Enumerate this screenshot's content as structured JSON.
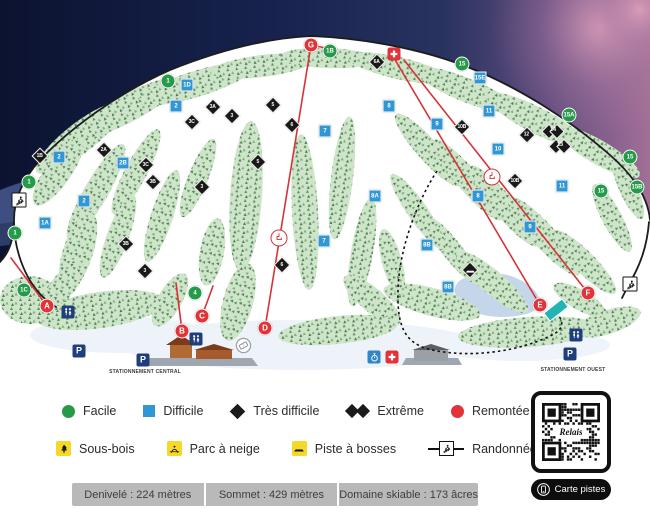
{
  "map": {
    "parking_labels": [
      {
        "text": "STATIONNEMENT CENTRAL",
        "x": 145,
        "y": 372
      },
      {
        "text": "STATIONNEMENT OUEST",
        "x": 573,
        "y": 370
      }
    ],
    "markers": [
      {
        "kind": "green",
        "label": "1",
        "x": 168,
        "y": 81
      },
      {
        "kind": "green",
        "label": "1B",
        "x": 330,
        "y": 51
      },
      {
        "kind": "green",
        "label": "1",
        "x": 29,
        "y": 182
      },
      {
        "kind": "green",
        "label": "1",
        "x": 15,
        "y": 233
      },
      {
        "kind": "green",
        "label": "1C",
        "x": 24,
        "y": 290
      },
      {
        "kind": "green",
        "label": "4",
        "x": 195,
        "y": 293
      },
      {
        "kind": "green",
        "label": "15",
        "x": 462,
        "y": 64
      },
      {
        "kind": "green",
        "label": "15A",
        "x": 569,
        "y": 115
      },
      {
        "kind": "green",
        "label": "15",
        "x": 630,
        "y": 157
      },
      {
        "kind": "green",
        "label": "15B",
        "x": 637,
        "y": 187
      },
      {
        "kind": "green",
        "label": "15",
        "x": 601,
        "y": 191
      },
      {
        "kind": "blue",
        "label": "1D",
        "x": 187,
        "y": 85
      },
      {
        "kind": "blue",
        "label": "2",
        "x": 176,
        "y": 106
      },
      {
        "kind": "blue",
        "label": "2",
        "x": 59,
        "y": 157
      },
      {
        "kind": "blue",
        "label": "2",
        "x": 84,
        "y": 201
      },
      {
        "kind": "blue",
        "label": "2B",
        "x": 123,
        "y": 163
      },
      {
        "kind": "blue",
        "label": "1A",
        "x": 45,
        "y": 223
      },
      {
        "kind": "blue",
        "label": "7",
        "x": 325,
        "y": 131
      },
      {
        "kind": "blue",
        "label": "7",
        "x": 324,
        "y": 241
      },
      {
        "kind": "blue",
        "label": "8",
        "x": 389,
        "y": 106
      },
      {
        "kind": "blue",
        "label": "8",
        "x": 478,
        "y": 196
      },
      {
        "kind": "blue",
        "label": "8A",
        "x": 375,
        "y": 196
      },
      {
        "kind": "blue",
        "label": "8B",
        "x": 427,
        "y": 245
      },
      {
        "kind": "blue",
        "label": "8B",
        "x": 448,
        "y": 287
      },
      {
        "kind": "blue",
        "label": "9",
        "x": 437,
        "y": 124
      },
      {
        "kind": "blue",
        "label": "9",
        "x": 530,
        "y": 227
      },
      {
        "kind": "blue",
        "label": "10",
        "x": 498,
        "y": 149
      },
      {
        "kind": "blue",
        "label": "11",
        "x": 489,
        "y": 111
      },
      {
        "kind": "blue",
        "label": "11",
        "x": 562,
        "y": 186
      },
      {
        "kind": "blue",
        "label": "15E",
        "x": 480,
        "y": 78
      },
      {
        "kind": "diamond",
        "label": "1B",
        "x": 40,
        "y": 156
      },
      {
        "kind": "diamond",
        "label": "2A",
        "x": 104,
        "y": 150
      },
      {
        "kind": "diamond",
        "label": "3A",
        "x": 213,
        "y": 107
      },
      {
        "kind": "diamond",
        "label": "3",
        "x": 232,
        "y": 116
      },
      {
        "kind": "diamond",
        "label": "3C",
        "x": 192,
        "y": 122
      },
      {
        "kind": "diamond",
        "label": "3C",
        "x": 146,
        "y": 165
      },
      {
        "kind": "diamond",
        "label": "3B",
        "x": 153,
        "y": 182
      },
      {
        "kind": "diamond",
        "label": "3B",
        "x": 126,
        "y": 244
      },
      {
        "kind": "diamond",
        "label": "3",
        "x": 202,
        "y": 187
      },
      {
        "kind": "diamond",
        "label": "3",
        "x": 145,
        "y": 271
      },
      {
        "kind": "diamond",
        "label": "5",
        "x": 273,
        "y": 105
      },
      {
        "kind": "diamond",
        "label": "5",
        "x": 258,
        "y": 162
      },
      {
        "kind": "diamond",
        "label": "6",
        "x": 292,
        "y": 125
      },
      {
        "kind": "diamond",
        "label": "6",
        "x": 282,
        "y": 265
      },
      {
        "kind": "diamond",
        "label": "6A",
        "x": 377,
        "y": 62
      },
      {
        "kind": "diamond",
        "label": "10B",
        "x": 462,
        "y": 127
      },
      {
        "kind": "diamond",
        "label": "10B",
        "x": 515,
        "y": 181
      },
      {
        "kind": "diamond",
        "label": "12",
        "x": 527,
        "y": 135
      },
      {
        "kind": "double",
        "label": "14",
        "x": 553,
        "y": 131
      },
      {
        "kind": "double",
        "label": "13",
        "x": 560,
        "y": 146
      },
      {
        "kind": "bosses",
        "label": "",
        "x": 470,
        "y": 270
      },
      {
        "kind": "lift",
        "label": "A",
        "x": 47,
        "y": 306
      },
      {
        "kind": "lift",
        "label": "B",
        "x": 182,
        "y": 331
      },
      {
        "kind": "lift",
        "label": "C",
        "x": 202,
        "y": 316
      },
      {
        "kind": "lift",
        "label": "D",
        "x": 265,
        "y": 328
      },
      {
        "kind": "lift",
        "label": "E",
        "x": 540,
        "y": 305
      },
      {
        "kind": "lift",
        "label": "F",
        "x": 588,
        "y": 293
      },
      {
        "kind": "lift",
        "label": "G",
        "x": 311,
        "y": 45
      },
      {
        "kind": "chair",
        "label": "",
        "x": 279,
        "y": 238
      },
      {
        "kind": "chair",
        "label": "",
        "x": 492,
        "y": 177
      },
      {
        "kind": "aid",
        "label": "",
        "x": 394,
        "y": 54
      },
      {
        "kind": "aid",
        "label": "",
        "x": 392,
        "y": 357
      },
      {
        "kind": "wc",
        "label": "",
        "x": 68,
        "y": 312
      },
      {
        "kind": "wc",
        "label": "",
        "x": 196,
        "y": 339
      },
      {
        "kind": "wc",
        "label": "",
        "x": 576,
        "y": 335
      },
      {
        "kind": "parking",
        "label": "P",
        "x": 79,
        "y": 351
      },
      {
        "kind": "parking",
        "label": "P",
        "x": 143,
        "y": 360
      },
      {
        "kind": "parking",
        "label": "P",
        "x": 570,
        "y": 354
      },
      {
        "kind": "ticket",
        "label": "",
        "x": 243,
        "y": 345
      },
      {
        "kind": "rando",
        "label": "",
        "x": 19,
        "y": 200
      },
      {
        "kind": "rando",
        "label": "",
        "x": 630,
        "y": 284
      },
      {
        "kind": "stopwatch",
        "label": "",
        "x": 374,
        "y": 357
      },
      {
        "kind": "carpet",
        "label": "",
        "x": 556,
        "y": 310
      }
    ]
  },
  "legend": {
    "difficulty": [
      {
        "icon": "green-circle",
        "label": "Facile"
      },
      {
        "icon": "blue-square",
        "label": "Difficile"
      },
      {
        "icon": "black-diamond",
        "label": "Très difficile"
      },
      {
        "icon": "double-black-diamond",
        "label": "Extrême"
      },
      {
        "icon": "red-circle",
        "label": "Remontée"
      }
    ],
    "features": [
      {
        "icon": "glades",
        "label": "Sous-bois"
      },
      {
        "icon": "terrain-park",
        "label": "Parc à neige"
      },
      {
        "icon": "moguls",
        "label": "Piste à bosses"
      },
      {
        "icon": "alpine-touring",
        "label": "Randonnée alpine"
      }
    ]
  },
  "stats": [
    "Denivelé : 224 mètres",
    "Sommet : 429 mètres",
    "Domaine skiable : 173 âcres"
  ],
  "qr": {
    "logo_text": "Relais",
    "button_label": "Carte pistes"
  },
  "colors": {
    "easy": "#259a49",
    "intermediate": "#3096d4",
    "expert": "#191919",
    "lift": "#e23438",
    "feature_yellow": "#f6d829",
    "facility_navy": "#1e3f7c",
    "sky_navy": "#17234e"
  }
}
